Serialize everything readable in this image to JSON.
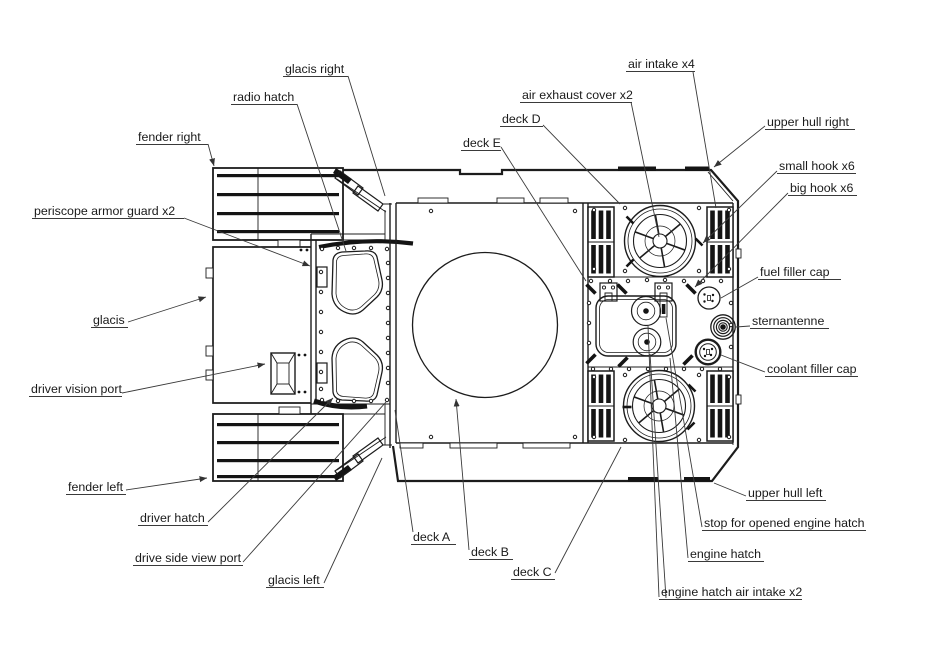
{
  "diagram": {
    "type": "technical-diagram",
    "subject": "tank hull top view with part callouts",
    "colors": {
      "background": "#ffffff",
      "line": "#1c1c1c",
      "label_text": "#1a1a1a",
      "dark_fill": "#141414"
    },
    "labels": [
      {
        "id": "glacis-right",
        "text": "glacis right"
      },
      {
        "id": "radio-hatch",
        "text": "radio hatch"
      },
      {
        "id": "fender-right",
        "text": "fender right"
      },
      {
        "id": "periscope-armor-guard",
        "text": "periscope armor guard x2"
      },
      {
        "id": "glacis",
        "text": "glacis"
      },
      {
        "id": "driver-vision-port",
        "text": "driver vision port"
      },
      {
        "id": "fender-left",
        "text": "fender left"
      },
      {
        "id": "driver-hatch",
        "text": "driver hatch"
      },
      {
        "id": "drive-side-view-port",
        "text": "drive side view port"
      },
      {
        "id": "glacis-left",
        "text": "glacis left"
      },
      {
        "id": "deck-a",
        "text": "deck A"
      },
      {
        "id": "deck-b",
        "text": "deck B"
      },
      {
        "id": "deck-c",
        "text": "deck C"
      },
      {
        "id": "deck-d",
        "text": "deck D"
      },
      {
        "id": "deck-e",
        "text": "deck E"
      },
      {
        "id": "air-exhaust-cover",
        "text": "air exhaust cover x2"
      },
      {
        "id": "air-intake",
        "text": "air intake x4"
      },
      {
        "id": "upper-hull-right",
        "text": "upper hull right"
      },
      {
        "id": "small-hook",
        "text": "small hook x6"
      },
      {
        "id": "big-hook",
        "text": "big hook x6"
      },
      {
        "id": "fuel-filler-cap",
        "text": "fuel filler cap"
      },
      {
        "id": "sternantenne",
        "text": "sternantenne"
      },
      {
        "id": "coolant-filler-cap",
        "text": "coolant filler cap"
      },
      {
        "id": "upper-hull-left",
        "text": "upper hull left"
      },
      {
        "id": "stop-for-opened-engine-hatch",
        "text": "stop for opened engine hatch"
      },
      {
        "id": "engine-hatch",
        "text": "engine hatch"
      },
      {
        "id": "engine-hatch-air-intake",
        "text": "engine hatch air intake x2"
      }
    ]
  }
}
